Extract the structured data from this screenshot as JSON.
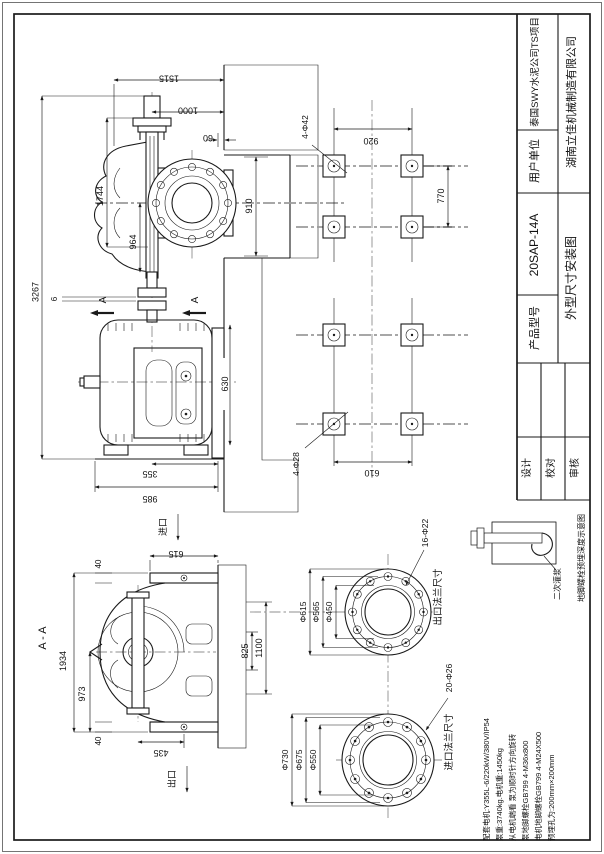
{
  "title_block": {
    "customer_label": "用户单位",
    "customer_value": "泰国SWY水泥公司TS项目",
    "manufacturer": "湖南立佳机械制造有限公司",
    "model_label": "产品型号",
    "model_value": "20SAP-14A",
    "drawing_name": "外型尺寸安装图",
    "signoff_labels": [
      "设计",
      "校对",
      "审核"
    ]
  },
  "anchor_detail": {
    "caption": "地脚螺栓预埋深度示意图",
    "grout_label": "二次灌浆"
  },
  "specs": [
    "配套电机:Y355L-6/220kW/380V/IP54",
    "泵重:3740kg.电机重:1450kg",
    "从电机端看 泵为顺时针方向旋转",
    "泵地脚螺栓GB799 4-M36x800",
    "电机地脚螺栓GB799 4-M24X500",
    "预埋孔为:200mm×200mm"
  ],
  "elevation": {
    "dim_overall": "3267",
    "dim_pump_height": "1744",
    "dim_shaft": "964",
    "dim_top_width": "1515",
    "dim_axis_to_wall": "1000",
    "dim_gap": "60",
    "dim_opening": "910",
    "dim_wall": "630",
    "dim_motor": "355",
    "dim_base": "985",
    "dim_coupling_gap": "6",
    "section_letter": "A"
  },
  "bolt_plan": {
    "pump_holes_label": "4-Φ42",
    "pump_spacing_x": "920",
    "pump_spacing_y": "770",
    "motor_holes_label": "4-Φ28",
    "motor_spacing": "610"
  },
  "section_view": {
    "title": "A - A",
    "dim_total": "1934",
    "dim_base": "973",
    "dim_top_face": "615",
    "dim_bottom": "435",
    "dim_40_top": "40",
    "dim_40_bottom": "40",
    "dim_outlet_pos": "825",
    "dim_outlet_face": "1100",
    "inlet_label": "进口",
    "outlet_label": "出口"
  },
  "flanges": {
    "outlet_title": "出口法兰尺寸",
    "outlet_holes": "16-Φ22",
    "outlet_d": [
      "Φ615",
      "Φ565",
      "Φ450"
    ],
    "inlet_title": "进口法兰尺寸",
    "inlet_holes": "20-Φ26",
    "inlet_d": [
      "Φ730",
      "Φ675",
      "Φ550"
    ]
  }
}
